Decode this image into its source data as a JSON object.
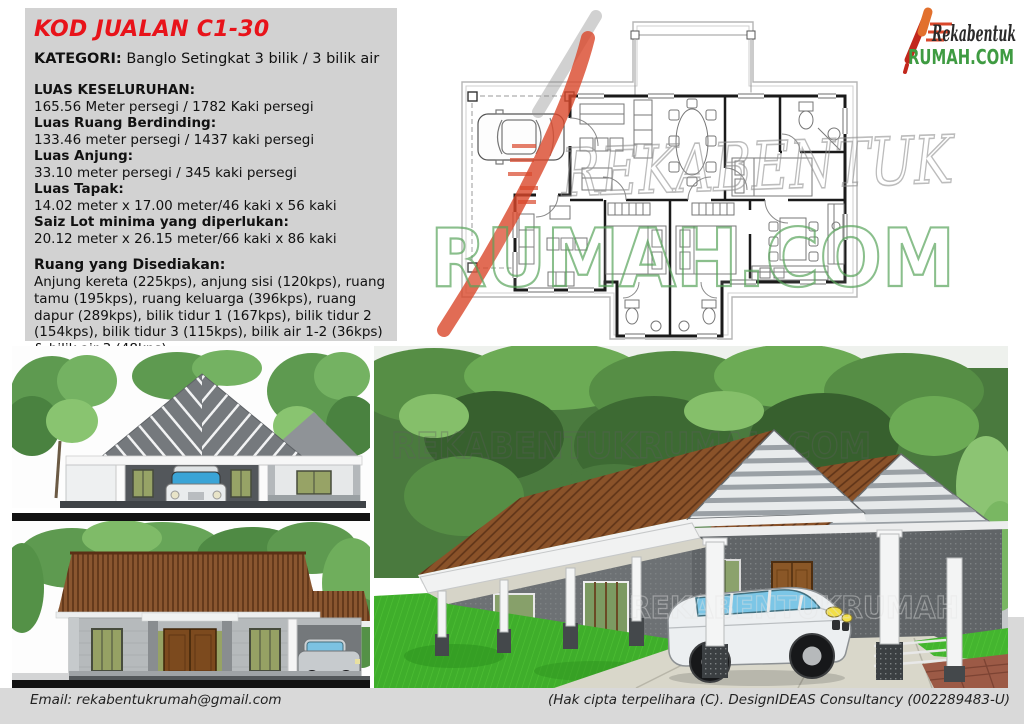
{
  "info_panel": {
    "title": "KOD JUALAN C1-30",
    "kategori_label": "KATEGORI:",
    "kategori_value": "Banglo Setingkat 3 bilik / 3 bilik air",
    "specs": [
      {
        "label": "LUAS KESELURUHAN:",
        "value": "165.56  Meter persegi / 1782 Kaki persegi"
      },
      {
        "label": "Luas Ruang Berdinding:",
        "value": "133.46 meter persegi / 1437 kaki persegi"
      },
      {
        "label": "Luas Anjung:",
        "value": "33.10 meter persegi / 345 kaki persegi"
      },
      {
        "label": "Luas Tapak:",
        "value": "14.02 meter x 17.00 meter/46 kaki x 56 kaki"
      },
      {
        "label": "Saiz Lot minima yang diperlukan:",
        "value": "20.12 meter x 26.15 meter/66 kaki x 86 kaki"
      }
    ],
    "rooms_heading": "Ruang yang Disediakan:",
    "rooms_text": "Anjung kereta (225kps), anjung sisi (120kps), ruang tamu (195kps), ruang keluarga (396kps), ruang dapur (289kps), bilik tidur 1 (167kps), bilik tidur 2 (154kps), bilik tidur 3 (115kps), bilik air 1-2 (36kps) & bilik air 3 (48kps)"
  },
  "logo": {
    "line1": "Rekabentuk",
    "line2": "RUMAH.COM"
  },
  "watermark": {
    "plan_text1": "REKABENTUK",
    "plan_text2": "RUMAH.COM",
    "render_text1": "REKABENTUKRUMAH.COM",
    "render_text2": "REKABENTUKRUMAH"
  },
  "footer": {
    "email": "Email: rekabentukrumah@gmail.com",
    "copyright": "(Hak cipta terpelihara (C). DesignIDEAS Consultancy (002289483-U)"
  },
  "colors": {
    "accent_red": "#e8131a",
    "logo_green": "#3f9b42",
    "panel_gray": "#d2d2d2",
    "footer_gray": "#d9d9d9",
    "roof_brown": "#8a5630"
  }
}
